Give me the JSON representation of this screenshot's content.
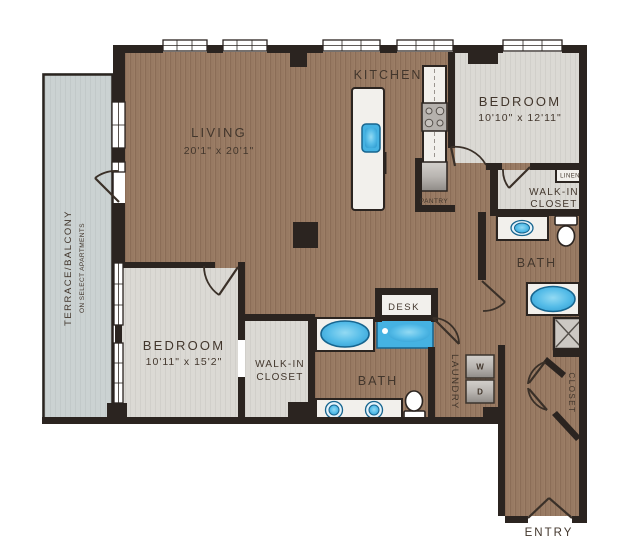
{
  "plan_title": "Two bedroom apartment floor plan",
  "rooms": {
    "living": {
      "name": "LIVING",
      "dims": "20'1\" x 20'1\""
    },
    "kitchen": {
      "name": "KITCHEN"
    },
    "bedroom1": {
      "name": "BEDROOM",
      "dims": "10'10\" x 12'11\""
    },
    "bedroom2": {
      "name": "BEDROOM",
      "dims": "10'11\" x 15'2\""
    },
    "walkin1": {
      "line1": "WALK-IN",
      "line2": "CLOSET"
    },
    "walkin2": {
      "line1": "WALK-IN",
      "line2": "CLOSET"
    },
    "bath1": {
      "name": "BATH"
    },
    "bath2": {
      "name": "BATH"
    },
    "linen": {
      "name": "LINEN"
    },
    "pantry": {
      "name": "PANTRY"
    },
    "desk": {
      "name": "DESK"
    },
    "laundry": {
      "name": "LAUNDRY"
    },
    "closet": {
      "name": "CLOSET"
    },
    "entry": {
      "name": "ENTRY"
    },
    "terrace": {
      "line1": "TERRACE/BALCONY",
      "line2": "ON SELECT APARTMENTS"
    }
  },
  "appliances": {
    "washer": "W",
    "dryer": "D"
  },
  "colors": {
    "wood_floor": "#9c7e66",
    "wood_stripe": "#8b6d57",
    "room_floor": "#dbd9d4",
    "terrace_floor": "#cbd2d2",
    "wall": "#2b2420",
    "fixture_blue": "#45b2e2",
    "fixture_blue_dark": "#17658f",
    "fixture_white": "#f2f0ec",
    "label_text": "#42362c"
  }
}
